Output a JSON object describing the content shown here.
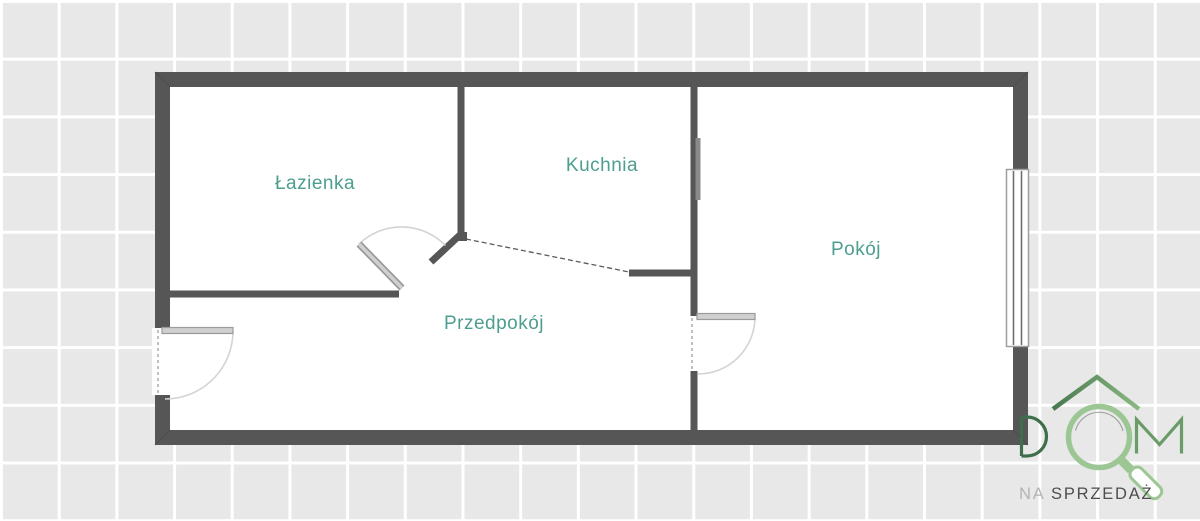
{
  "floorplan": {
    "rooms": [
      {
        "label": "Łazienka"
      },
      {
        "label": "Kuchnia"
      },
      {
        "label": "Pokój"
      },
      {
        "label": "Przedpokój"
      }
    ],
    "features": [
      "entrance-door",
      "bathroom-door",
      "room-door",
      "window",
      "open-passage-dashed"
    ]
  },
  "logo": {
    "word": "DOM",
    "tagline_prefix": "NA",
    "tagline_main": "SPRZEDAŻ"
  },
  "icons": {
    "house_roof": "house-roof-icon",
    "magnifier": "magnifying-glass-icon"
  },
  "colors": {
    "wall": "#565656",
    "room_fill": "#ffffff",
    "label": "#4d9e8e",
    "bg": "#e8e8e8",
    "grid_line": "#ffffff",
    "leaf_fill": "#d0d0d0",
    "leaf_edge": "#9b9b9b",
    "arc": "#d4d4d4",
    "threshold": "#c0c0c0",
    "window_frame": "#9e9e9e",
    "window_mullion": "#6f6f6f",
    "logo_green_dark": "#3f6e4b",
    "logo_green_mid": "#699c66",
    "logo_green_light": "#9cc795",
    "tagline_prefix_color": "#b4b4b4",
    "tagline_main_color": "#4e4e4e"
  }
}
